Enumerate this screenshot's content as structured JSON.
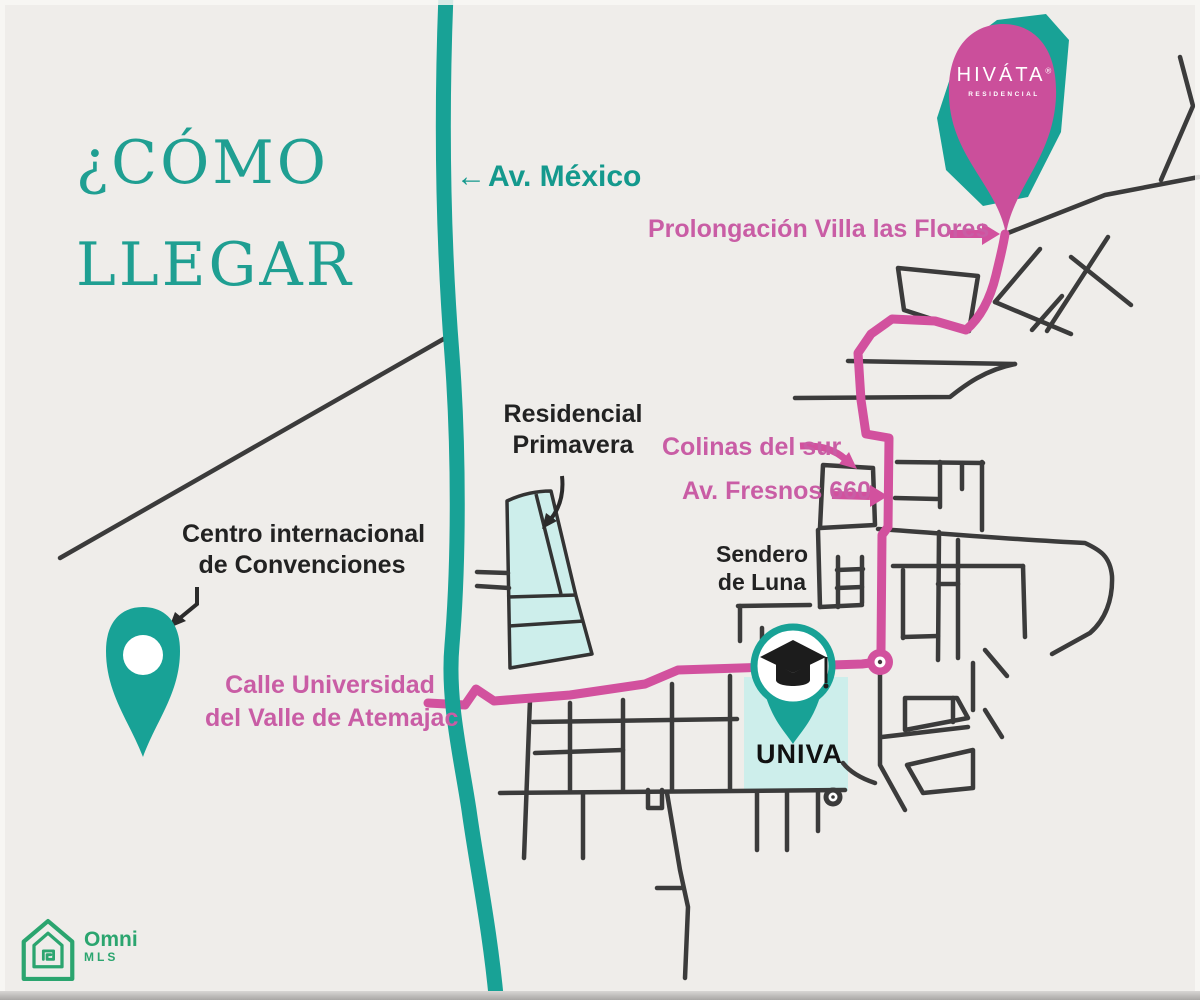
{
  "colors": {
    "background": "#efedea",
    "teal": "#18a296",
    "pink_route": "#d2519e",
    "pink_text": "#c95da5",
    "street": "#3b3b3b",
    "block_fill": "#cdeeeb",
    "logo_green": "#2ba56f"
  },
  "title": {
    "line1": "¿CÓMO",
    "line2": "LLEGAR"
  },
  "streets": {
    "av_mexico": {
      "arrow": "←",
      "label": "Av. México"
    },
    "prolongacion_label": "Prolongación Villa las Flores",
    "colinas_label": "Colinas del sur",
    "fresnos_label": "Av. Fresnos 660",
    "calle_universidad": {
      "line1": "Calle Universidad",
      "line2": "del Valle de Atemajac"
    }
  },
  "places": {
    "residencial_primavera": {
      "line1": "Residencial",
      "line2": "Primavera"
    },
    "centro_convenciones": {
      "line1": "Centro internacional",
      "line2": "de Convenciones"
    },
    "sendero_luna": {
      "line1": "Sendero",
      "line2": "de Luna"
    },
    "univa": "UNIVA",
    "hivata": {
      "name": "HIVÁTA",
      "mark": "®",
      "subtitle": "RESIDENCIAL"
    }
  },
  "logo": {
    "brand": "Omni",
    "sub": "MLS"
  }
}
